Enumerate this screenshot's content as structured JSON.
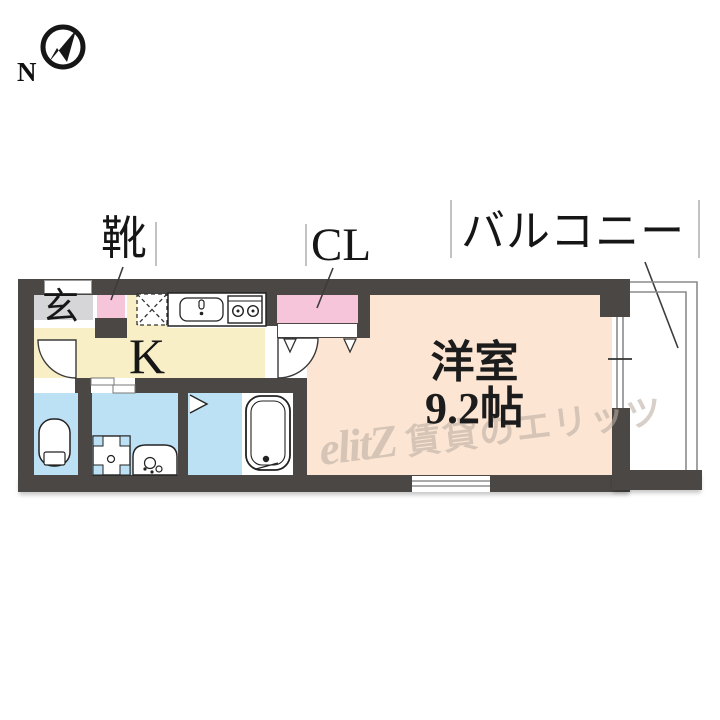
{
  "compass": {
    "north_label": "N"
  },
  "callouts": {
    "shoes": {
      "label": "靴"
    },
    "closet": {
      "label": "CL"
    },
    "balcony": {
      "label": "バルコニー"
    }
  },
  "rooms": {
    "entrance_label": "玄",
    "kitchen_label": "K",
    "main_room_name": "洋室",
    "main_room_size": "9.2帖"
  },
  "watermark": {
    "logo": "elitZ",
    "text": "賃貸のエリッツ"
  },
  "colors": {
    "wall": "#4a4744",
    "entrance_gray": "#d6d6d8",
    "closet_pink": "#f7c5da",
    "kitchen_cream": "#f8efc7",
    "room_peach": "#fce5d2",
    "wet_blue": "#bde1f4",
    "watermark": "#bcaea2"
  }
}
